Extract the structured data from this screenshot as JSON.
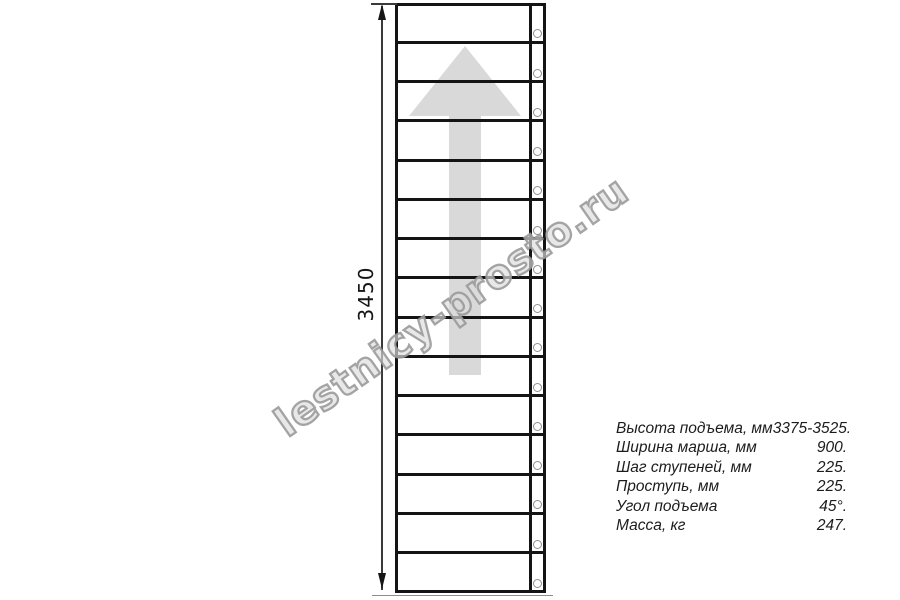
{
  "watermark": {
    "text": "lestnicy-prosto.ru"
  },
  "drawing": {
    "dimension_label": "3450",
    "treads": 15,
    "balusters": 15,
    "arrow_direction": "up"
  },
  "specs": {
    "rows": [
      {
        "label": "Высота подъема, мм",
        "value": "3375-3525."
      },
      {
        "label": "Ширина марша, мм",
        "value": "900."
      },
      {
        "label": "Шаг ступеней, мм",
        "value": "225."
      },
      {
        "label": "Проступь, мм",
        "value": "225."
      },
      {
        "label": "Угол подъема",
        "value": "45°."
      },
      {
        "label": "Масса, кг",
        "value": "247."
      }
    ]
  },
  "colors": {
    "line": "#141414",
    "arrow_fill": "#d9d9d9",
    "baluster_stroke": "#8f8f8f",
    "watermark_stroke": "#989898",
    "background": "#ffffff"
  }
}
